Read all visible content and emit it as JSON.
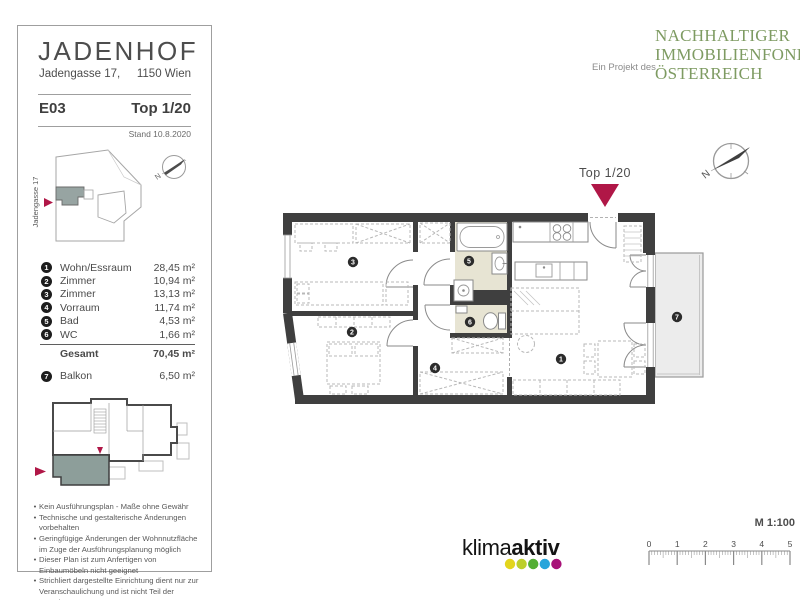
{
  "header": {
    "title": "JADENHOF",
    "address1": "Jadengasse 17,",
    "address2": "1150 Wien",
    "unit": "E03",
    "top": "Top 1/20",
    "stand": "Stand 10.8.2020"
  },
  "site": {
    "street_label": "Jadengasse 17",
    "compass_n": "N"
  },
  "rooms": {
    "items": [
      {
        "num": "1",
        "label": "Wohn/Essraum",
        "area": "28,45 m²"
      },
      {
        "num": "2",
        "label": "Zimmer",
        "area": "10,94 m²"
      },
      {
        "num": "3",
        "label": "Zimmer",
        "area": "13,13 m²"
      },
      {
        "num": "4",
        "label": "Vorraum",
        "area": "11,74 m²"
      },
      {
        "num": "5",
        "label": "Bad",
        "area": "4,53 m²"
      },
      {
        "num": "6",
        "label": "WC",
        "area": "1,66 m²"
      }
    ],
    "total_label": "Gesamt",
    "total_area": "70,45 m²",
    "extra": {
      "num": "7",
      "label": "Balkon",
      "area": "6,50 m²"
    }
  },
  "notes": [
    "Kein Ausführungsplan - Maße ohne Gewähr",
    "Technische und gestalterische Änderungen vorbehalten",
    "Geringfügige Änderungen der Wohnnutzfläche im Zuge der Ausführungsplanung möglich",
    "Dieser Plan ist zum Anfertigen von Einbaumöbeln nicht geeignet",
    "Strichliert dargestellte Einrichtung dient nur zur Veranschaulichung und ist nicht Teil der Grundausstattung"
  ],
  "brand": {
    "prefix": "Ein Projekt des",
    "lines": [
      "NACHHALTIGER",
      "IMMOBILIENFONDS",
      "ÖSTERREICH"
    ],
    "green": "#7e9b62"
  },
  "plan": {
    "top_label": "Top 1/20",
    "compass_n": "N",
    "numbers": [
      "1",
      "2",
      "3",
      "4",
      "5",
      "6",
      "7"
    ]
  },
  "footer": {
    "klima": "klima",
    "aktiv": "aktiv",
    "scale_label": "M 1:100",
    "ticks": [
      "0",
      "1",
      "2",
      "3",
      "4",
      "5"
    ]
  },
  "colors": {
    "accent_red": "#b01747",
    "logo_green": "#7e9b62",
    "wall": "#3f3f3f",
    "bath_floor": "#e7e4d3",
    "balcony": "#ececec",
    "unit_highlight": "#8d9e9a",
    "klima_dots": [
      "#e3d51c",
      "#bccf2b",
      "#53ae35",
      "#27a5db",
      "#a81178"
    ]
  }
}
